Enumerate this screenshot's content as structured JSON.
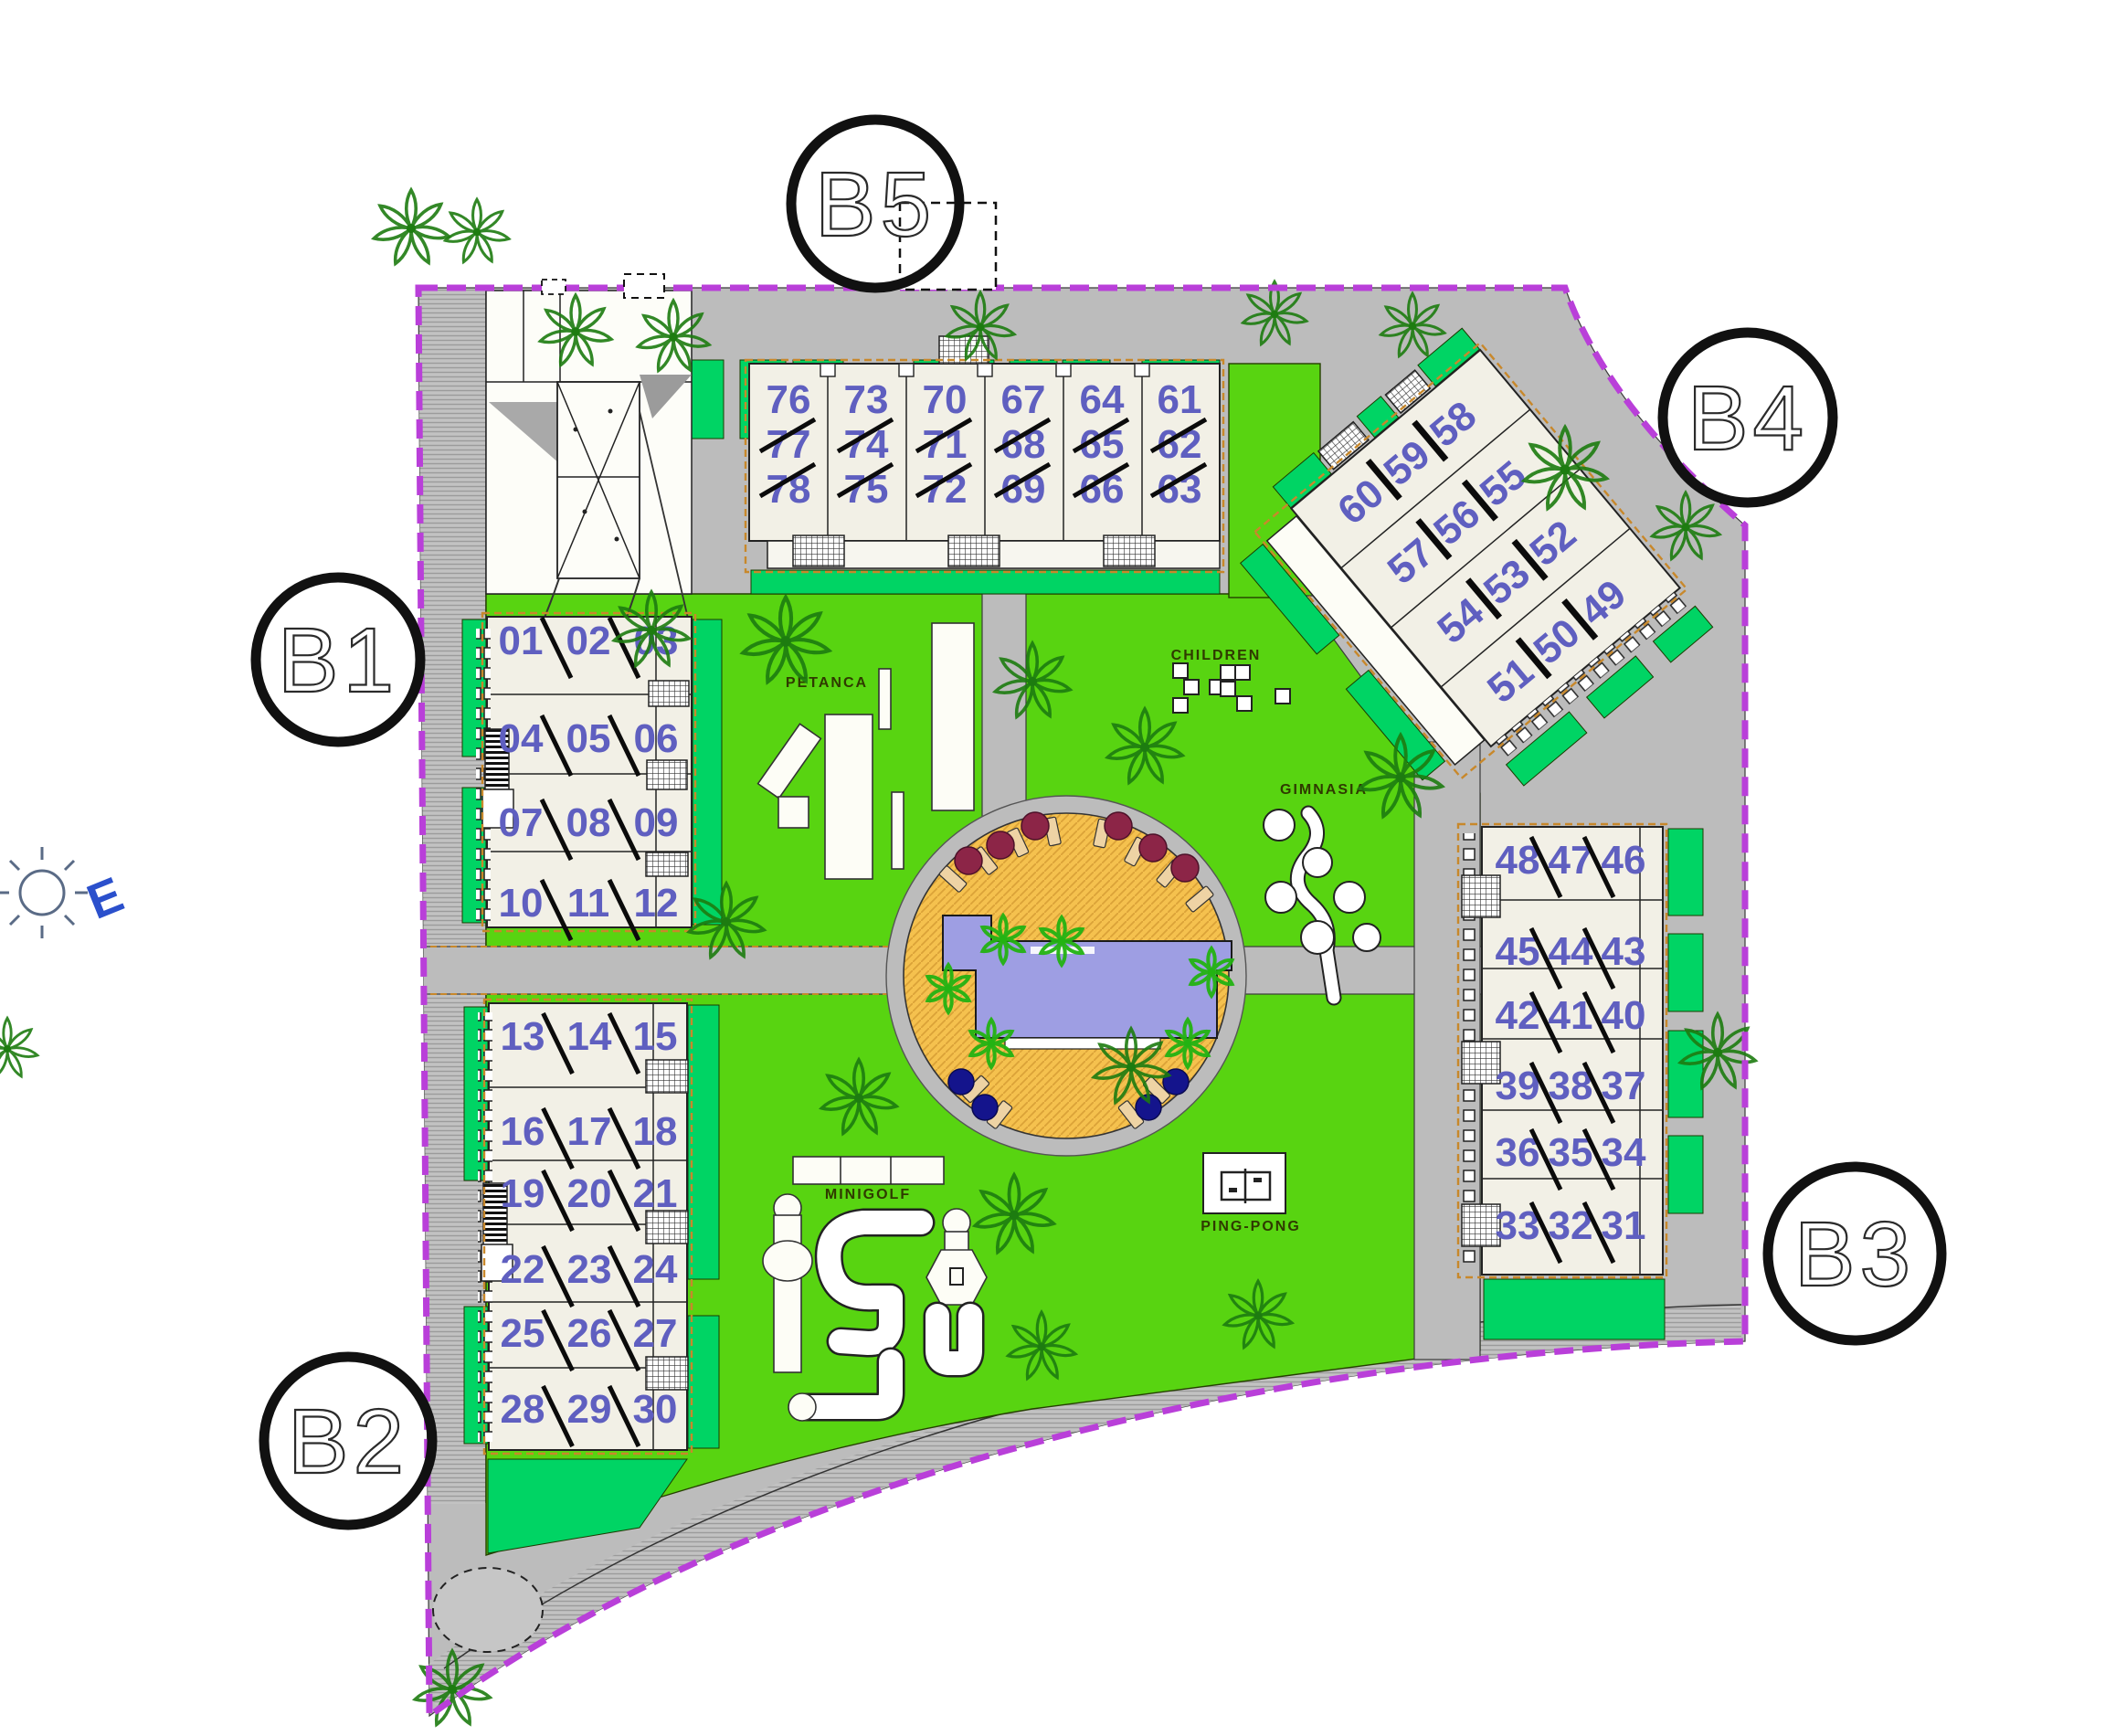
{
  "blocks": {
    "b1": {
      "label": "B1",
      "units": [
        [
          "01",
          "02",
          "03"
        ],
        [
          "04",
          "05",
          "06"
        ],
        [
          "07",
          "08",
          "09"
        ],
        [
          "10",
          "11",
          "12"
        ]
      ]
    },
    "b2": {
      "label": "B2",
      "units": [
        [
          "13",
          "14",
          "15"
        ],
        [
          "16",
          "17",
          "18"
        ],
        [
          "19",
          "20",
          "21"
        ],
        [
          "22",
          "23",
          "24"
        ],
        [
          "25",
          "26",
          "27"
        ],
        [
          "28",
          "29",
          "30"
        ]
      ]
    },
    "b3": {
      "label": "B3",
      "units": [
        [
          "48",
          "47",
          "46"
        ],
        [
          "45",
          "44",
          "43"
        ],
        [
          "42",
          "41",
          "40"
        ],
        [
          "39",
          "38",
          "37"
        ],
        [
          "36",
          "35",
          "34"
        ],
        [
          "33",
          "32",
          "31"
        ]
      ]
    },
    "b4": {
      "label": "B4",
      "units": [
        [
          "60",
          "59",
          "58"
        ],
        [
          "57",
          "56",
          "55"
        ],
        [
          "54",
          "53",
          "52"
        ],
        [
          "51",
          "50",
          "49"
        ]
      ]
    },
    "b5": {
      "label": "B5",
      "units": [
        [
          "76",
          "77",
          "78"
        ],
        [
          "73",
          "74",
          "75"
        ],
        [
          "70",
          "71",
          "72"
        ],
        [
          "67",
          "68",
          "69"
        ],
        [
          "64",
          "65",
          "66"
        ],
        [
          "61",
          "62",
          "63"
        ]
      ]
    }
  },
  "amenities": {
    "petanca": "PETANCA",
    "children": "CHILDREN",
    "gimnasia": "GIMNASIA",
    "minigolf": "MINIGOLF",
    "pingpong": "PING-PONG"
  },
  "compass": {
    "east": "E"
  },
  "colors": {
    "boundary": "#b93fd9",
    "lawn": "#58d411",
    "hedge": "#00d464",
    "road": "#bcbcbc",
    "pool": "#9e9ee3",
    "deck": "#f5c14e",
    "unit_number": "#5f5fc0"
  }
}
